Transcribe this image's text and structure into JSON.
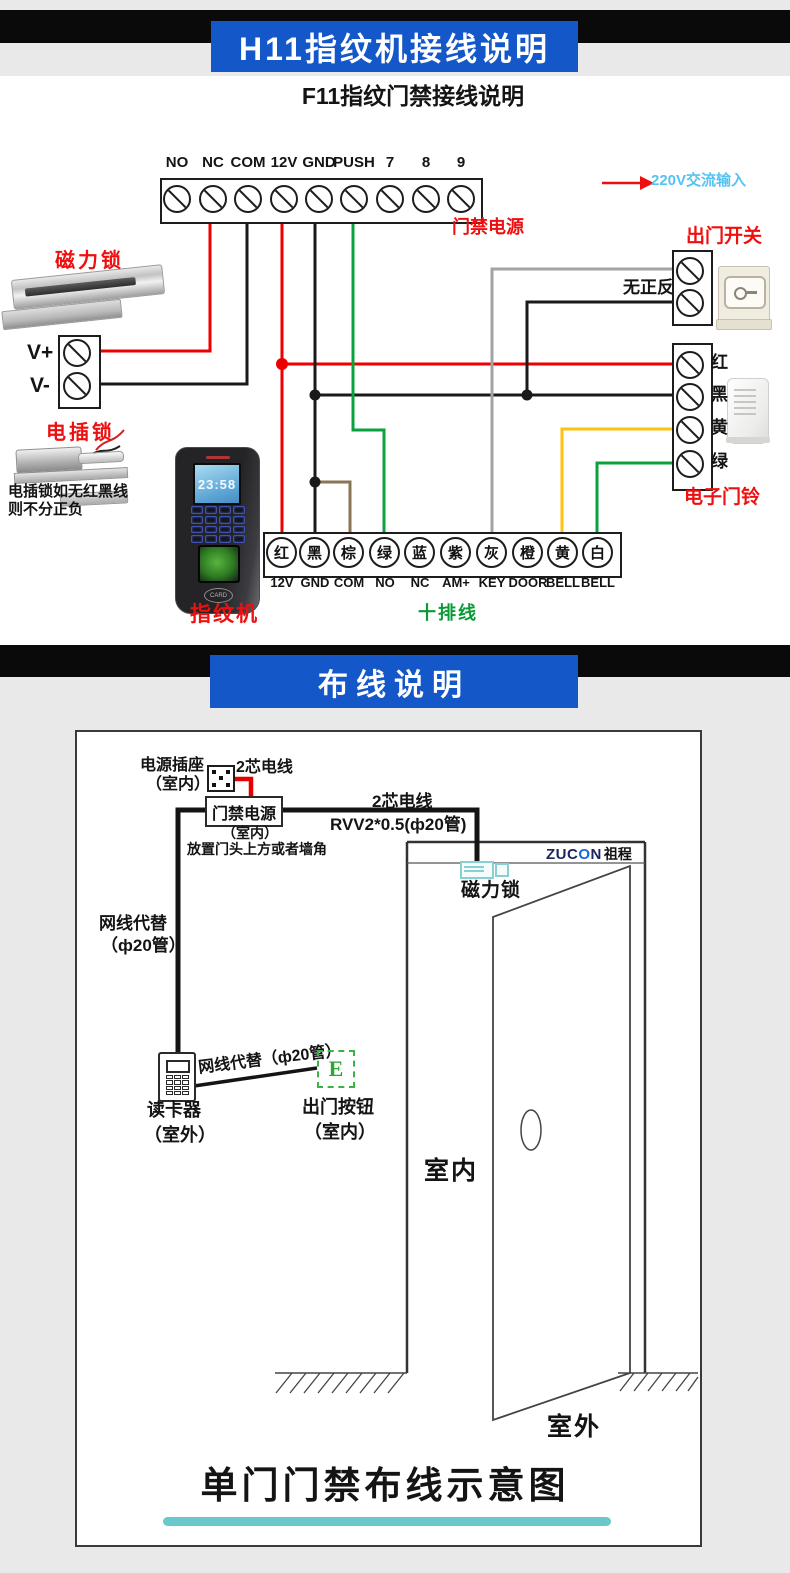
{
  "header1": {
    "title": "H11指纹机接线说明"
  },
  "header2": {
    "title": "布线说明"
  },
  "top": {
    "subtitle": "F11指纹门禁接线说明",
    "power_strip": {
      "pins": [
        "NO",
        "NC",
        "COM",
        "12V",
        "GND",
        "PUSH",
        "7",
        "8",
        "9"
      ],
      "caption": "门禁电源"
    },
    "ac_input": "220V交流输入",
    "maglock_label": "磁力锁",
    "v_plus": "V+",
    "v_minus": "V-",
    "bolt_label": "电插锁",
    "bolt_note1": "电插锁如无红黑线",
    "bolt_note2": "则不分正负",
    "fingerprint": {
      "time": "23:58",
      "card": "CARD",
      "label": "指纹机"
    },
    "ten_wire": {
      "caption": "十排线",
      "terminals": [
        {
          "c": "红",
          "pin": "12V"
        },
        {
          "c": "黑",
          "pin": "GND"
        },
        {
          "c": "棕",
          "pin": "COM"
        },
        {
          "c": "绿",
          "pin": "NO"
        },
        {
          "c": "蓝",
          "pin": "NC"
        },
        {
          "c": "紫",
          "pin": "AM+"
        },
        {
          "c": "灰",
          "pin": "KEY"
        },
        {
          "c": "橙",
          "pin": "DOOR"
        },
        {
          "c": "黄",
          "pin": "BELL"
        },
        {
          "c": "白",
          "pin": "BELL"
        }
      ]
    },
    "exit_switch": {
      "label": "出门开关",
      "note": "无正反"
    },
    "doorbell": {
      "label": "电子门铃",
      "terminals": [
        "红",
        "黑",
        "黄",
        "绿"
      ]
    }
  },
  "bottom": {
    "socket1": "电源插座",
    "socket2": "（室内）",
    "wire_a": "2芯电线",
    "psu": "门禁电源",
    "psu_sub1": "（室内）",
    "psu_sub2": "放置门头上方或者墙角",
    "wire_b1": "2芯电线",
    "wire_b2": "RVV2*0.5(ф20管)",
    "net1a": "网线代替",
    "net1b": "（ф20管）",
    "reader1": "读卡器",
    "reader2": "（室外）",
    "net2": "网线代替（ф20管）",
    "ebtn": "E",
    "exit1": "出门按钮",
    "exit2": "（室内）",
    "brand_z": "ZUC",
    "brand_o": "O",
    "brand_n": "N",
    "brand_cn": "祖程",
    "maglock": "磁力锁",
    "indoor": "室内",
    "outdoor": "室外",
    "title": "单门门禁布线示意图"
  },
  "colors": {
    "accent_blue": "#1457c8",
    "label_red": "#ee1010",
    "label_green": "#089b35",
    "ac_text_blue": "#56c2f0",
    "teal_bar": "#6bc8ca",
    "wire_red": "#ee0000",
    "wire_black": "#1a1a1a",
    "wire_green": "#0aa23d",
    "wire_yellow": "#ffc20e",
    "wire_gray": "#a3a3a3",
    "wire_brown": "#8a7456"
  }
}
